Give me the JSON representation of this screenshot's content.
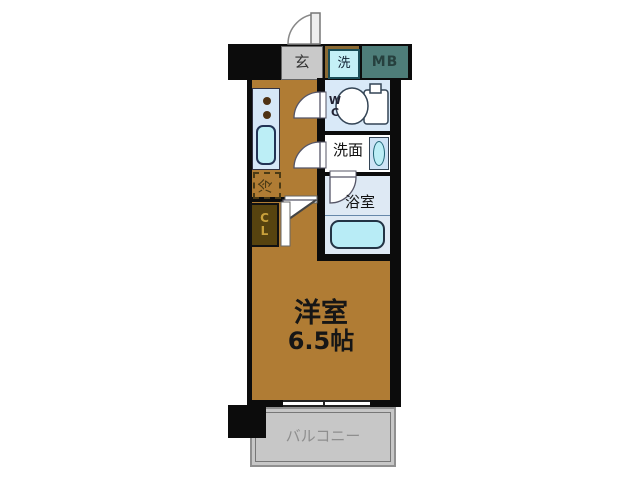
{
  "floorplan": {
    "type": "japanese-apartment-floorplan",
    "entrance_label": "玄",
    "washer_label": "洗",
    "meter_box_label": "MB",
    "wc_label_line1": "W",
    "wc_label_line2": "C",
    "washroom_label": "洗面",
    "bathroom_label": "浴室",
    "closet_label_line1": "C",
    "closet_label_line2": "L",
    "fridge_label": "冷",
    "main_room_label": "洋室",
    "main_room_size": "6.5帖",
    "balcony_label": "バルコニー",
    "colors": {
      "room_brown": "#b07c34",
      "wall_black": "#0c0c0c",
      "meter_box_teal": "#4e7d79",
      "wet_area_blue": "#d9e9f8",
      "fixture_cyan": "#bceef6",
      "kitchen_counter_blue": "#d6e7f7",
      "balcony_gray": "#c7c7c7",
      "entrance_gray": "#c9c9c9",
      "closet_olive": "#57430f",
      "closet_text_gold": "#c9a13b",
      "balcony_text_gray": "#8e8e8e"
    }
  }
}
